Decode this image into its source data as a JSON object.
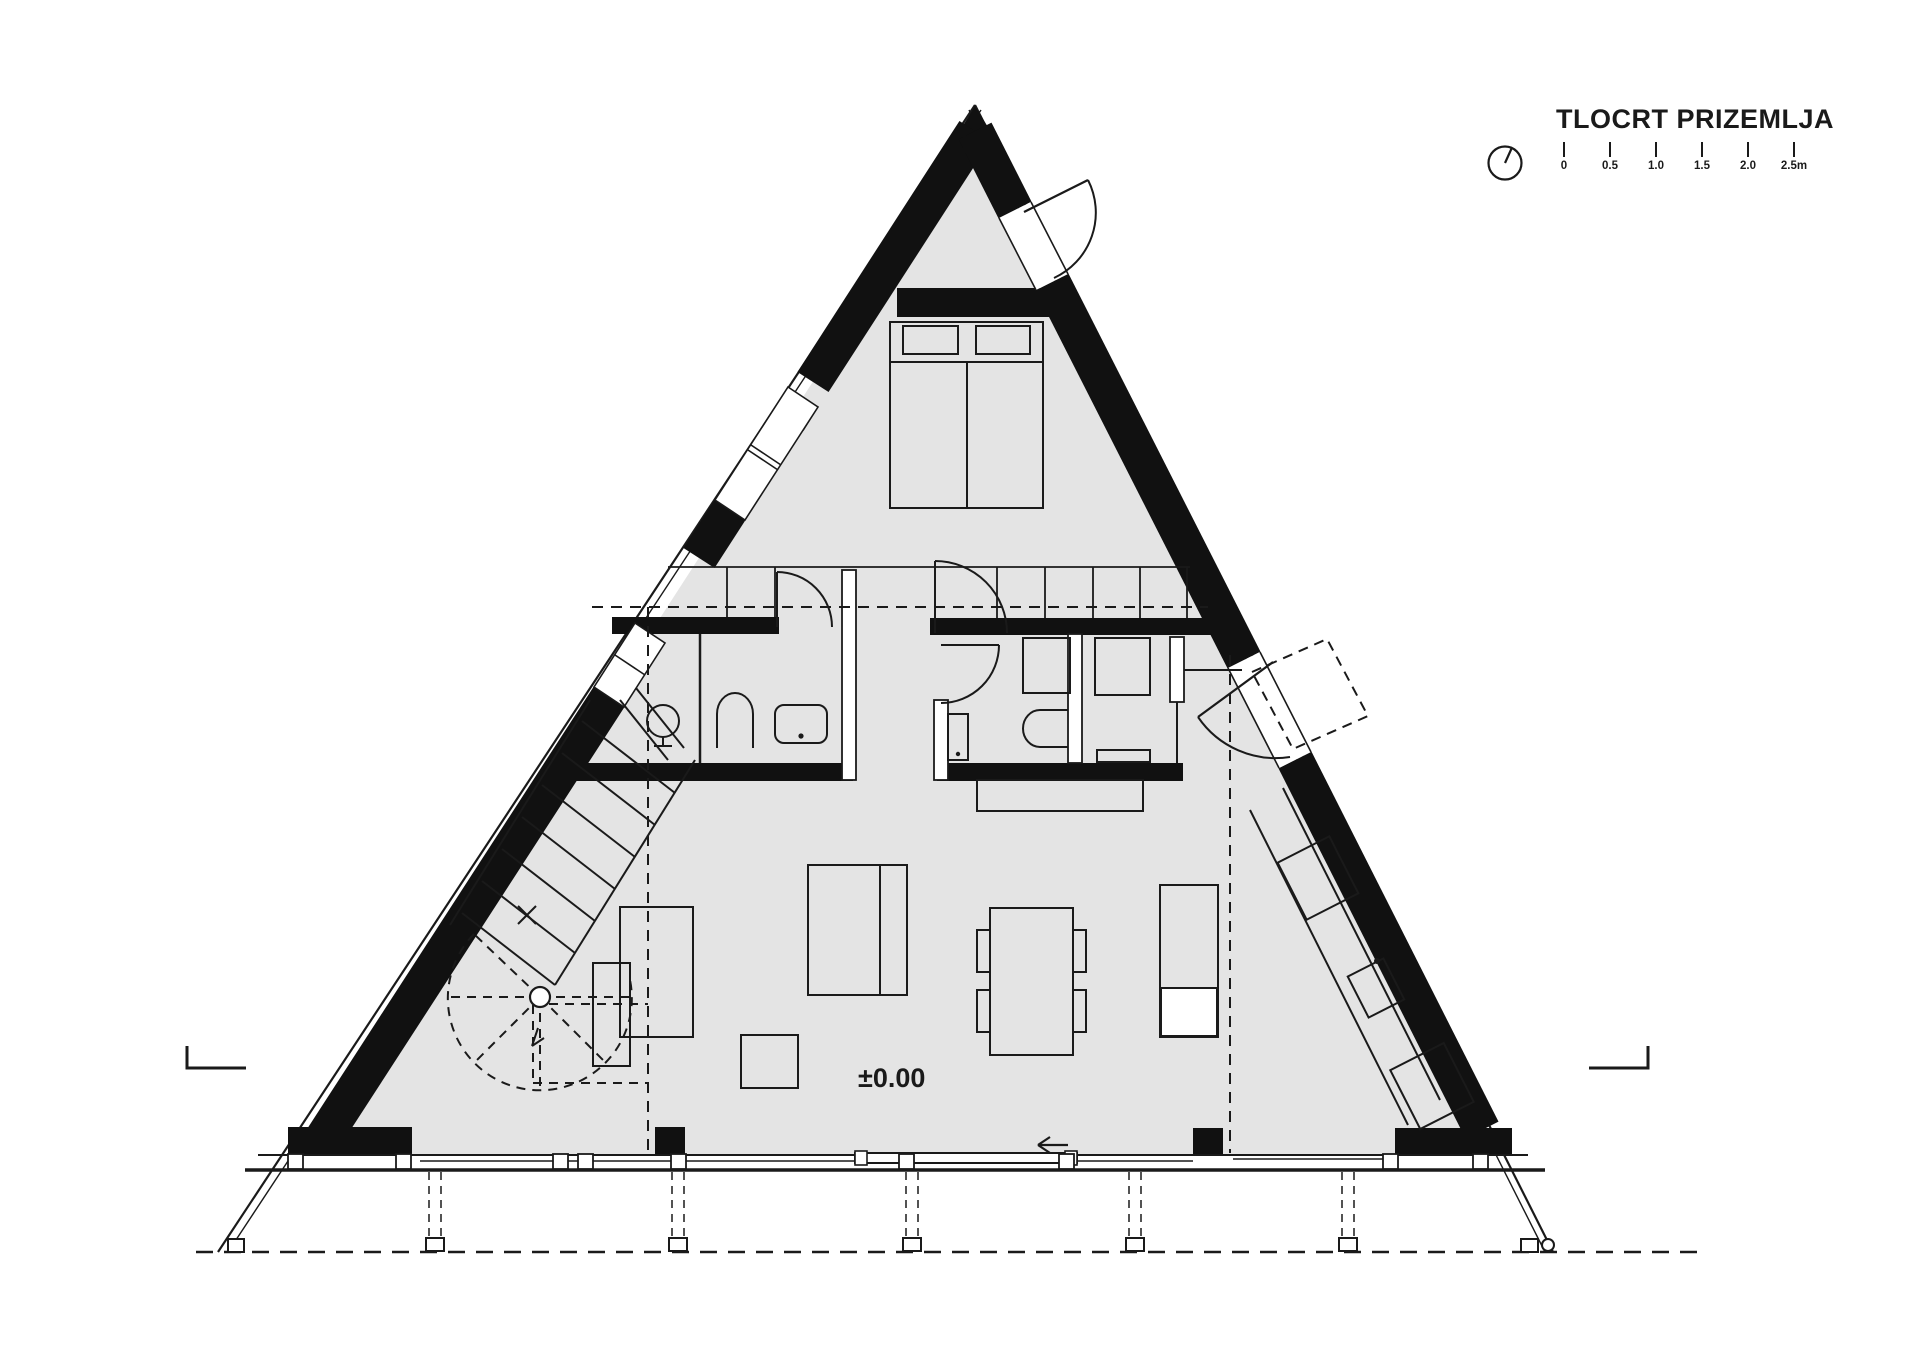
{
  "plan": {
    "title": "TLOCRT PRIZEMLJA",
    "elevation_label": "±0.00",
    "scale_bar": {
      "ticks": [
        "0",
        "0.5",
        "1.0",
        "1.5",
        "2.0",
        "2.5m"
      ]
    },
    "icons": {
      "north": "north-indicator-icon"
    },
    "colors": {
      "background": "#ffffff",
      "floor_fill": "#e4e4e4",
      "wall_fill": "#111111",
      "line": "#1a1a1a"
    }
  }
}
